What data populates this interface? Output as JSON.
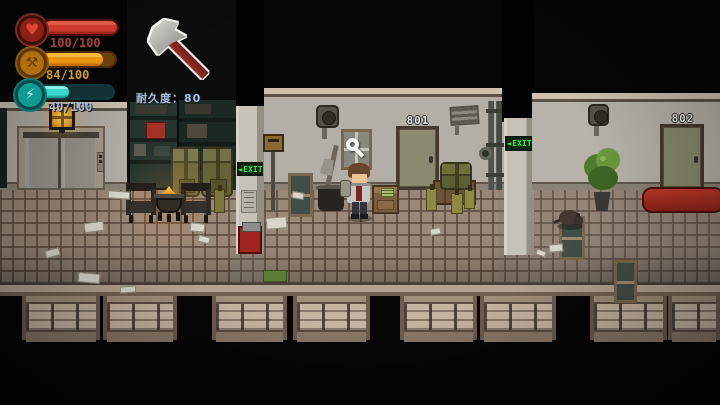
{
  "hud": {
    "health": {
      "value": "100/100",
      "pct": 100,
      "color": "#cd3a2c",
      "icon": "heart"
    },
    "stamina": {
      "value": "84/100",
      "pct": 84,
      "color": "#eb9410",
      "icon": "crossed-tools"
    },
    "energy": {
      "value": "40/100",
      "pct": 40,
      "color": "#38d8ce",
      "icon": "lightning"
    },
    "equipped": {
      "item": "axe",
      "durability_text": "耐久度：80"
    }
  },
  "scene": {
    "doors": [
      {
        "number": "801"
      },
      {
        "number": "802"
      }
    ],
    "exit_signs": [
      {
        "arrow": "◄",
        "text": "EXIT"
      },
      {
        "arrow": "◄",
        "text": "EXIT"
      }
    ],
    "colors": {
      "exit_green": "#42e84e",
      "bench_red": "#a3281e",
      "fire_orange": "#f09020"
    }
  }
}
